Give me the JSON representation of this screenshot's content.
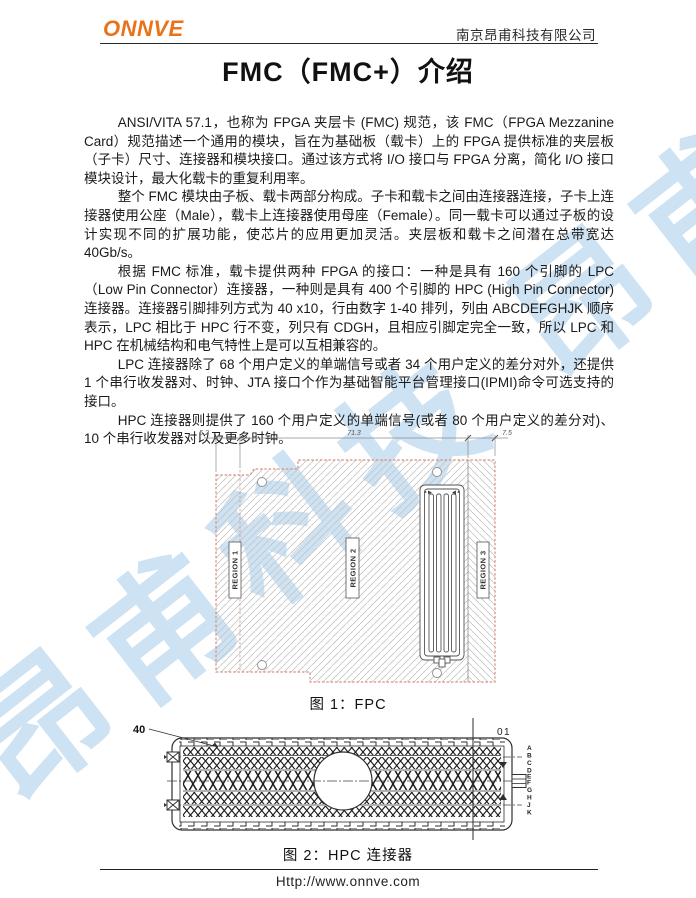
{
  "header": {
    "logo": "ONNVE",
    "company": "南京昂甫科技有限公司"
  },
  "title": "FMC（FMC+）介绍",
  "body": {
    "paragraphs": [
      "ANSI/VITA 57.1，也称为 FPGA 夹层卡 (FMC) 规范，该 FMC（FPGA Mezzanine Card）规范描述一个通用的模块，旨在为基础板（载卡）上的 FPGA 提供标准的夹层板（子卡）尺寸、连接器和模块接口。通过该方式将 I/O 接口与 FPGA 分离，简化 I/O 接口模块设计，最大化载卡的重复利用率。",
      "整个 FMC 模块由子板、载卡两部分构成。子卡和载卡之间由连接器连接，子卡上连接器使用公座（Male），载卡上连接器使用母座（Female）。同一载卡可以通过子板的设计实现不同的扩展功能，使芯片的应用更加灵活。夹层板和载卡之间潜在总带宽达 40Gb/s。",
      "根据 FMC 标准，载卡提供两种 FPGA 的接口：一种是具有 160 个引脚的 LPC（Low Pin Connector）连接器，一种则是具有 400 个引脚的 HPC (High Pin Connector) 连接器。连接器引脚排列方式为 40 x10，行由数字 1-40 排列，列由 ABCDEFGHJK 顺序表示，LPC 相比于 HPC 行不变，列只有 CDGH，且相应引脚定完全一致，所以 LPC 和 HPC 在机械结构和电气特性上是可以互相兼容的。",
      "LPC 连接器除了 68 个用户定义的单端信号或者 34 个用户定义的差分对外，还提供 1 个串行收发器对、时钟、JTA 接口个作为基础智能平台管理接口(IPMI)命令可选支持的接口。",
      "HPC 连接器则提供了 160 个用户定义的单端信号(或者 80 个用户定义的差分对)、10 个串行收发器对以及更多时钟。"
    ]
  },
  "figure1": {
    "caption": "图 1：FPC",
    "dim_labels": [
      "5.2",
      "71.3",
      "7.5"
    ],
    "regions": [
      "REGION 1",
      "REGION 2",
      "REGION 3"
    ]
  },
  "figure2": {
    "caption": "图 2：HPC 连接器",
    "pin_start_label": "40",
    "pin_end_label": "01",
    "row_letters": [
      "A",
      "B",
      "C",
      "D",
      "E",
      "F",
      "G",
      "H",
      "J",
      "K"
    ]
  },
  "footer": {
    "url": "Http://www.onnve.com"
  },
  "watermark": {
    "text": "昂甫科技 昂甫科技",
    "color": "#cde2f3"
  },
  "colors": {
    "logo_orange": "#E8731A",
    "board_outline": "#d98f7d",
    "hatch_gray": "#c4c4c4"
  }
}
